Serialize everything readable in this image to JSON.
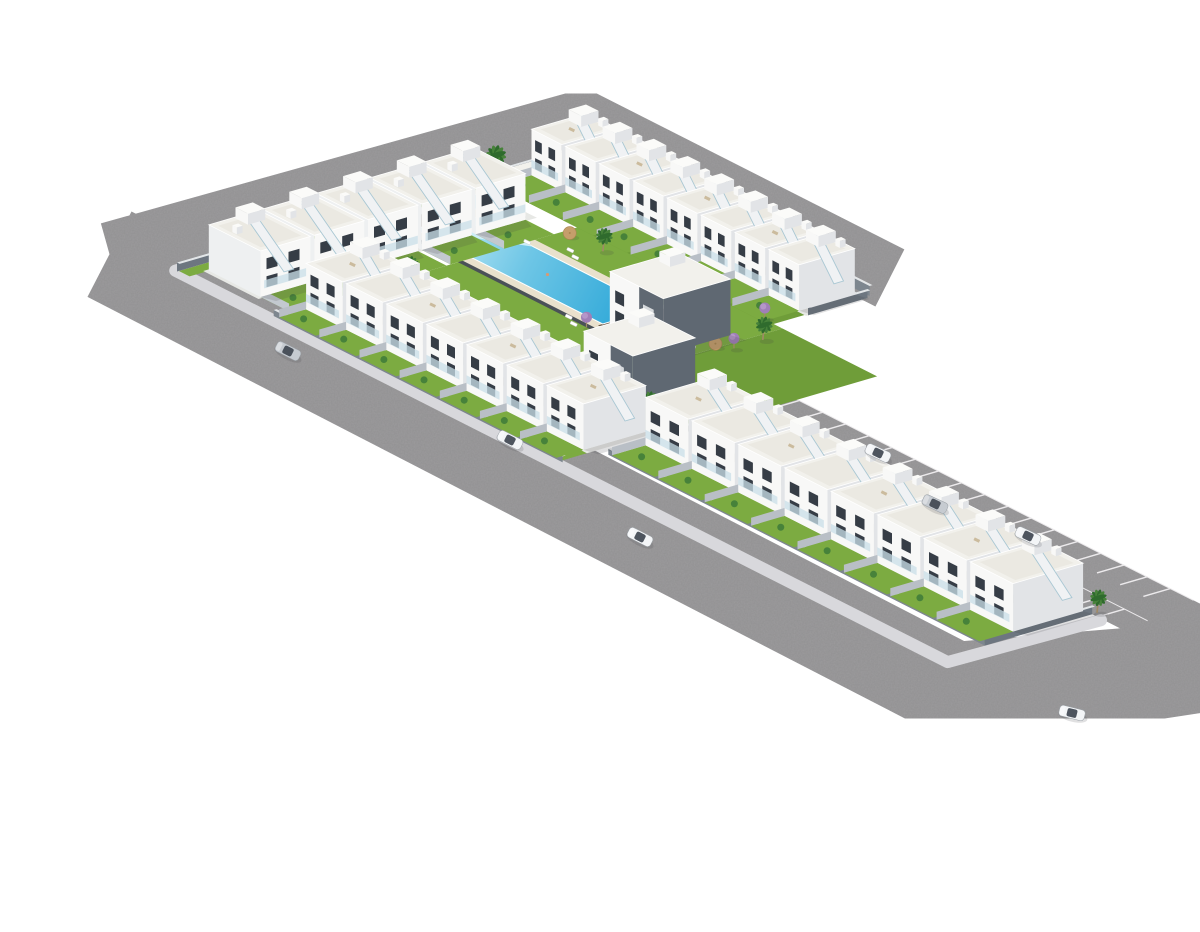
{
  "meta": {
    "alt": "Aerial 3D architectural render of an L-shaped white townhouse development with central pool courtyard, ring road, parking bays and cars",
    "house_unit_count": 28,
    "car_count": 7
  },
  "palette": {
    "bg": "#ffffff",
    "asphalt": "#9c9b9d",
    "asphaltDark": "#8f8e90",
    "sidewalk": "#d8d8dc",
    "stallLine": "#eceaec",
    "lawn": "#7cab41",
    "lawnDark": "#6f9d39",
    "concrete": "#e7e8e5",
    "wallFaceU": "#7d868f",
    "wallFaceV": "#6d7680",
    "wallTop": "#e3e6e8",
    "houseFront": "#f8f8f7",
    "houseSide": "#e2e4e7",
    "houseSide2": "#eef0f1",
    "roof": "#f2f1ec",
    "roofInset": "#e9e7e0",
    "window": "#363d46",
    "glass": "#c9dfe8",
    "stair": "#f0f2f4",
    "stairEdge": "#a9c7d3",
    "deck": "#e9e1cd",
    "deckWood": "#6e5b49",
    "poolShallow": "#cdeef8",
    "poolLight": "#bfeaf6",
    "poolDeep": "#2fa8d8",
    "poolWall": "#4a5157",
    "kidsPool": "#8fd9ef",
    "palmLeafA": "#2f6b2d",
    "palmLeafB": "#47823a",
    "trunk": "#a08a66",
    "parasol": "#c59e6b",
    "parasolEdge": "#a9854f",
    "jacaranda": "#a07fb8",
    "jacarandaLight": "#b596c9",
    "accent": "#5f6872",
    "carSilver": "#c6cbd1",
    "carWhite": "#f3f5f7",
    "carGlass": "#3c444e",
    "shadow": "rgba(60,65,70,0.16)"
  },
  "projection": {
    "origin": [
      150,
      256
    ],
    "u": [
      0.892,
      0.452
    ],
    "v": [
      0.96,
      -0.28
    ]
  },
  "roads": [
    {
      "name": "ring-road-northwest",
      "line": [
        [
          -58,
          -30
        ],
        [
          -50,
          455
        ],
        [
          295,
          455
        ]
      ],
      "width": 64
    },
    {
      "name": "ring-road-southwest",
      "line": [
        [
          -58,
          -30
        ],
        [
          900,
          -40
        ],
        [
          950,
          90
        ],
        [
          985,
          245
        ]
      ],
      "width": 96
    }
  ],
  "parking": {
    "area": [
      [
        425,
        150
      ],
      [
        960,
        150
      ],
      [
        960,
        235
      ],
      [
        425,
        235
      ]
    ],
    "stallRows": [
      {
        "b0": 150,
        "b1": 178,
        "a0": 440,
        "n": 17,
        "step": 26
      },
      {
        "b0": 207,
        "b1": 235,
        "a0": 430,
        "n": 17,
        "step": 26
      }
    ]
  },
  "sidewalks": [
    {
      "name": "perimeter-sidewalk",
      "line": [
        [
          -8,
          448
        ],
        [
          -8,
          -8
        ],
        [
          858,
          -8
        ],
        [
          862,
          148
        ]
      ],
      "width": 12
    }
  ],
  "lawns": [
    [
      [
        96,
        93
      ],
      [
        96,
        318
      ],
      [
        322,
        318
      ],
      [
        322,
        93
      ]
    ],
    [
      [
        4,
        314
      ],
      [
        312,
        314
      ],
      [
        312,
        352
      ],
      [
        4,
        352
      ]
    ],
    [
      [
        100,
        0
      ],
      [
        417,
        0
      ],
      [
        417,
        28
      ],
      [
        100,
        28
      ]
    ],
    [
      [
        430,
        40
      ],
      [
        846,
        40
      ],
      [
        846,
        75
      ],
      [
        430,
        75
      ]
    ],
    [
      [
        -6,
        -6
      ],
      [
        6,
        -6
      ],
      [
        6,
        446
      ],
      [
        -6,
        446
      ]
    ],
    [
      [
        322,
        93
      ],
      [
        428,
        93
      ],
      [
        428,
        318
      ],
      [
        322,
        318
      ]
    ]
  ],
  "rowGrounds": [
    [
      [
        4,
        10
      ],
      [
        66,
        10
      ],
      [
        66,
        300
      ],
      [
        4,
        300
      ]
    ],
    [
      [
        2,
        350
      ],
      [
        314,
        350
      ],
      [
        314,
        414
      ],
      [
        2,
        414
      ]
    ],
    [
      [
        98,
        26
      ],
      [
        417,
        26
      ],
      [
        417,
        95
      ],
      [
        98,
        95
      ]
    ],
    [
      [
        428,
        73
      ],
      [
        848,
        73
      ],
      [
        848,
        150
      ],
      [
        428,
        150
      ]
    ]
  ],
  "walls": [
    {
      "line": [
        [
          0,
          418
        ],
        [
          312,
          418
        ]
      ],
      "h": 10
    },
    {
      "line": [
        [
          -6,
          -8
        ],
        [
          -6,
          446
        ]
      ],
      "h": 9
    },
    {
      "line": [
        [
          96,
          -2
        ],
        [
          420,
          -2
        ]
      ],
      "h": 6
    },
    {
      "line": [
        [
          428,
          38
        ],
        [
          850,
          38
        ]
      ],
      "h": 6
    },
    {
      "line": [
        [
          850,
          38
        ],
        [
          850,
          150
        ]
      ],
      "h": 9
    },
    {
      "line": [
        [
          314,
          352
        ],
        [
          314,
          414
        ]
      ],
      "h": 9
    },
    {
      "line": [
        [
          428,
          93
        ],
        [
          428,
          150
        ]
      ],
      "h": 8
    }
  ],
  "pool": {
    "deck": [
      [
        22,
        195
      ],
      [
        252,
        195
      ],
      [
        252,
        270
      ],
      [
        22,
        270
      ]
    ],
    "darkWall": [
      [
        32,
        190
      ],
      [
        252,
        190
      ],
      [
        252,
        206
      ],
      [
        32,
        206
      ]
    ],
    "water": [
      [
        32,
        205
      ],
      [
        242,
        205
      ],
      [
        242,
        260
      ],
      [
        32,
        260
      ]
    ],
    "shallowWedge": [
      [
        32,
        260
      ],
      [
        105,
        260
      ],
      [
        32,
        205
      ]
    ],
    "woodDeckA": [
      [
        14,
        200
      ],
      [
        32,
        200
      ],
      [
        32,
        265
      ],
      [
        14,
        265
      ]
    ],
    "woodDeckB": [
      [
        242,
        200
      ],
      [
        262,
        200
      ],
      [
        262,
        265
      ],
      [
        242,
        265
      ]
    ]
  },
  "kidsPool": {
    "deck": [
      [
        2,
        266
      ],
      [
        46,
        266
      ],
      [
        46,
        298
      ],
      [
        2,
        298
      ]
    ],
    "water": [
      [
        8,
        271
      ],
      [
        40,
        271
      ],
      [
        40,
        293
      ],
      [
        8,
        293
      ]
    ]
  },
  "shed": {
    "a": [
      0,
      20
    ],
    "b": [
      330,
      392
    ],
    "h": 11
  },
  "rows": [
    {
      "name": "northwest-row",
      "dir": "v",
      "units": 5,
      "aBox": [
        6,
        64
      ],
      "b0": 14,
      "step": 56,
      "h": 46,
      "garden": [
        64,
        96
      ]
    },
    {
      "name": "northeast-row",
      "dir": "u",
      "units": 8,
      "bBox": [
        352,
        410
      ],
      "a0": 4,
      "step": 38,
      "h": 46,
      "garden": [
        314,
        352
      ]
    },
    {
      "name": "southwest-row",
      "dir": "u",
      "units": 7,
      "bBox": [
        28,
        93
      ],
      "a0": 100,
      "step": 45,
      "h": 46,
      "garden": [
        0,
        28
      ]
    },
    {
      "name": "south-wing-row",
      "dir": "u",
      "units": 8,
      "bBox": [
        75,
        148
      ],
      "a0": 430,
      "step": 52,
      "h": 48,
      "garden": [
        40,
        75
      ]
    }
  ],
  "buildings": [
    {
      "name": "clubhouse-building",
      "a": [
        250,
        310
      ],
      "b": [
        205,
        275
      ],
      "h": 56
    },
    {
      "name": "corner-building",
      "a": [
        323,
        378
      ],
      "b": [
        110,
        175
      ],
      "h": 56
    }
  ],
  "palms": [
    [
      -14,
      60,
      1.2
    ],
    [
      -14,
      190,
      1.2
    ],
    [
      -14,
      330,
      1.2
    ],
    [
      40,
      428,
      1.3
    ],
    [
      140,
      428,
      1.3
    ],
    [
      240,
      428,
      1.3
    ],
    [
      100,
      135,
      1
    ],
    [
      210,
      115,
      1
    ],
    [
      140,
      300,
      1
    ],
    [
      250,
      305,
      1
    ],
    [
      310,
      140,
      1
    ],
    [
      330,
      290,
      1
    ],
    [
      205,
      255,
      0.9
    ],
    [
      850,
      155,
      1
    ],
    [
      385,
      120,
      0.9
    ]
  ],
  "jacarandas": [
    [
      240,
      190
    ],
    [
      320,
      195
    ],
    [
      330,
      260
    ],
    [
      385,
      170
    ],
    [
      300,
      320
    ]
  ],
  "parasols": [
    [
      60,
      210
    ],
    [
      105,
      298
    ],
    [
      225,
      300
    ],
    [
      280,
      118
    ],
    [
      150,
      112
    ],
    [
      320,
      250
    ]
  ],
  "loungers": [
    [
      125,
      280
    ],
    [
      137,
      274
    ],
    [
      218,
      192
    ],
    [
      230,
      186
    ],
    [
      58,
      292
    ],
    [
      310,
      235
    ],
    [
      96,
      262
    ]
  ],
  "cars": [
    {
      "x": 248,
      "y": 335,
      "r": 27,
      "c": "silver"
    },
    {
      "x": 470,
      "y": 424,
      "r": 27,
      "c": "white"
    },
    {
      "x": 600,
      "y": 521,
      "r": 27,
      "c": "white"
    },
    {
      "x": 838,
      "y": 437,
      "r": 25,
      "c": "white"
    },
    {
      "x": 895,
      "y": 488,
      "r": 25,
      "c": "silver"
    },
    {
      "x": 988,
      "y": 520,
      "r": 25,
      "c": "white"
    },
    {
      "x": 1032,
      "y": 697,
      "r": 14,
      "c": "white"
    }
  ]
}
